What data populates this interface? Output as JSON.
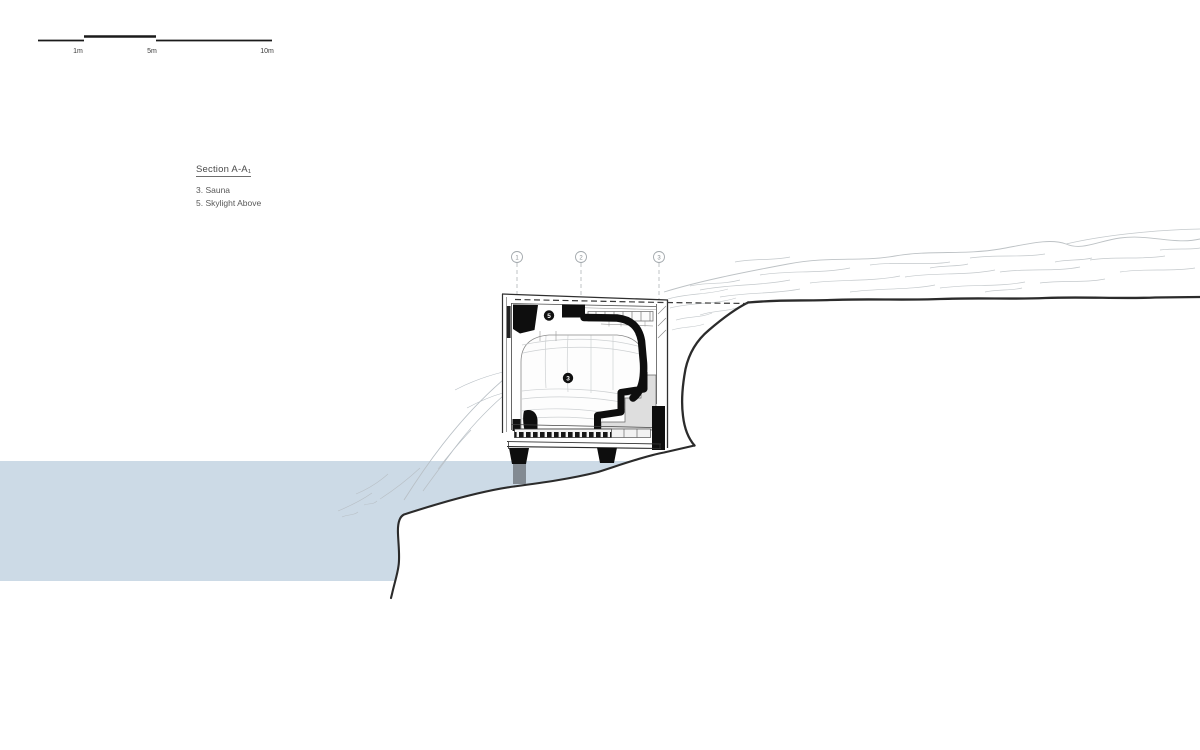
{
  "scale_bar": {
    "labels": [
      "1m",
      "5m",
      "10m"
    ]
  },
  "title_block": {
    "title": "Section A-A₁",
    "notes": [
      "3. Sauna",
      "5. Skylight Above"
    ]
  },
  "grid_markers": [
    "1",
    "2",
    "3"
  ],
  "callouts": {
    "skylight": "5",
    "sauna": "3"
  },
  "colors": {
    "water": "#ccdae6",
    "ink": "#2b2b2b",
    "sketch": "#c3c8cb",
    "black_fill": "#0e0e0e",
    "text": "#4c4c4c"
  }
}
